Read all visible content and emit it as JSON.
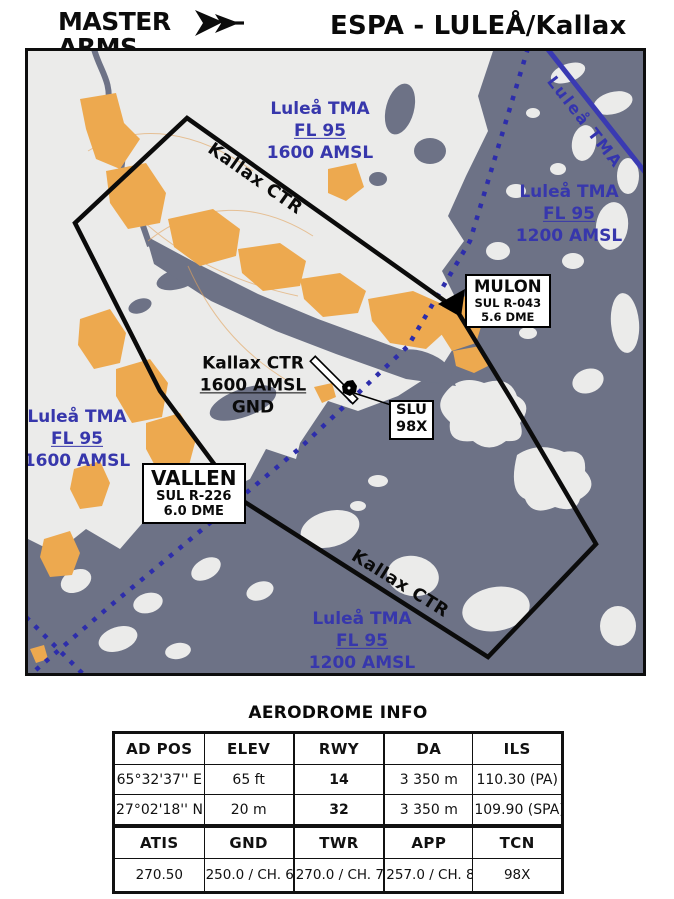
{
  "header": {
    "logo": {
      "name": "MASTER ARMS",
      "tagline": "A SWEDISH COMBAT FLIGHT SIMULATOR COMMUNITY"
    },
    "title": "ESPA - LULEÅ/Kallax"
  },
  "map": {
    "labels": {
      "tma_top": {
        "line1": "Luleå TMA",
        "line2": "FL 95",
        "line3": "1600 AMSL"
      },
      "ctr_top": "Kallax CTR",
      "tma_corner": "Luleå TMA",
      "tma_right": {
        "line1": "Luleå TMA",
        "line2": "FL 95",
        "line3": "1200 AMSL"
      },
      "ctr_center": {
        "line1": "Kallax CTR",
        "line2": "1600 AMSL",
        "line3": "GND"
      },
      "tma_left": {
        "line1": "Luleå TMA",
        "line2": "FL 95",
        "line3": "1600 AMSL"
      },
      "ctr_bottom": "Kallax CTR",
      "tma_bottom": {
        "line1": "Luleå TMA",
        "line2": "FL 95",
        "line3": "1200 AMSL"
      }
    },
    "waypoints": {
      "mulon": {
        "name": "MULON",
        "radial": "SUL R-043",
        "dme": "5.6 DME"
      },
      "vallen": {
        "name": "VALLEN",
        "radial": "SUL R-226",
        "dme": "6.0 DME"
      },
      "navaid": {
        "id": "SLU",
        "channel": "98X"
      }
    },
    "colors": {
      "water": "#6d7286",
      "land": "#ebebea",
      "urban": "#eda94f",
      "tma_blue": "#3737ac",
      "boundary_black": "#0b0b0b"
    }
  },
  "info": {
    "title": "AERODROME INFO",
    "table1": {
      "headers": [
        "AD POS",
        "ELEV",
        "RWY",
        "DA",
        "ILS"
      ],
      "rows": [
        [
          "65°32'37'' E",
          "65 ft",
          "14",
          "3 350 m",
          "110.30 (PA)"
        ],
        [
          "27°02'18'' N",
          "20 m",
          "32",
          "3 350 m",
          "109.90 (SPA)"
        ]
      ]
    },
    "table2": {
      "headers": [
        "ATIS",
        "GND",
        "TWR",
        "APP",
        "TCN"
      ],
      "rows": [
        [
          "270.50",
          "250.0 / CH. 6",
          "270.0 / CH. 7",
          "257.0 / CH. 8",
          "98X"
        ]
      ]
    }
  }
}
